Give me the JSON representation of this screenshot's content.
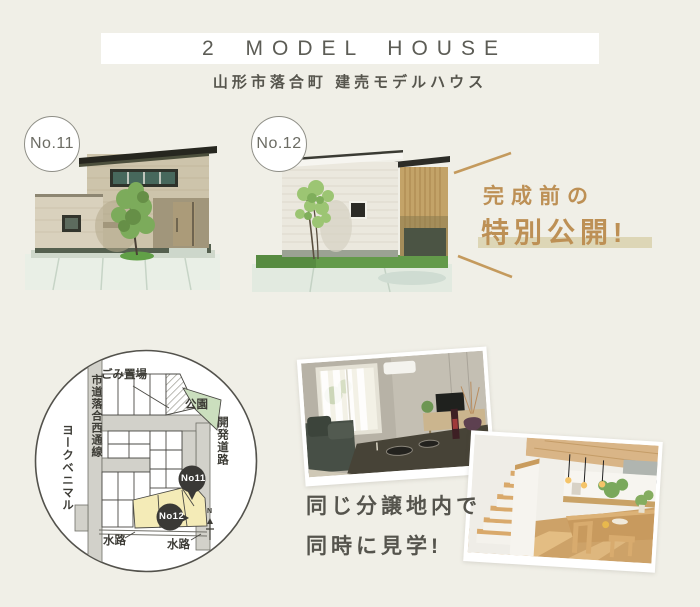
{
  "colors": {
    "background": "#f0efe7",
    "banner_bg": "#ffffff",
    "text_dark": "#56554d",
    "accent_tan": "#bd9055",
    "highlight_bar": "#ddd6b6",
    "map_marker": "#3a3936",
    "map_park_green": "#cbdfbe",
    "map_lot_yellow": "#f4ebb7"
  },
  "header": {
    "banner_title": "2 MODEL HOUSE",
    "subtitle": "山形市落合町 建売モデルハウス"
  },
  "houses": {
    "no11_badge": "No.11",
    "no12_badge": "No.12"
  },
  "promo": {
    "line1": "完成前の",
    "line2": "特別公開!"
  },
  "map": {
    "garbage": "ごみ置場",
    "park": "公園",
    "road_left": "市道落合西通線",
    "store": "ヨークベニマル",
    "road_right": "開発道路",
    "waterway_left": "水路",
    "waterway_right": "水路",
    "marker_no11": "No11",
    "marker_no12": "No12",
    "north": "N"
  },
  "viewing": {
    "line1": "同じ分譲地内で",
    "line2": "同時に見学!"
  }
}
